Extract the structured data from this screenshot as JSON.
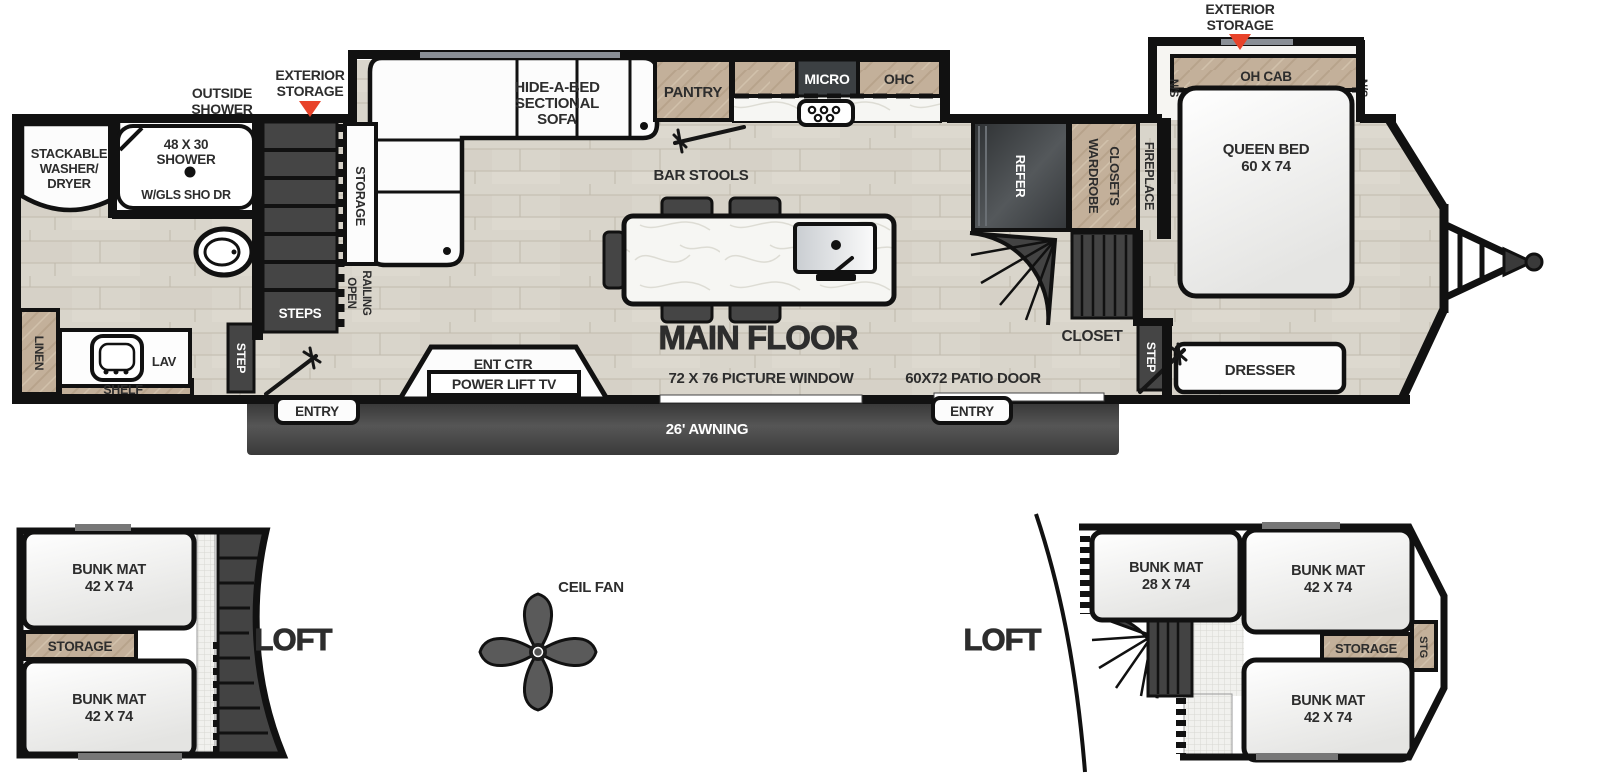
{
  "colors": {
    "floor_wood": "#d9d5cb",
    "cabinet_wood": "#c3b09a",
    "dark_fixture": "#454545",
    "wall": "#111111",
    "accent_red": "#e8432a",
    "awning_gray": "#484848",
    "counter_white": "#f6f6f3"
  },
  "main_floor": {
    "callouts": {
      "outside_shower_l1": "OUTSIDE",
      "outside_shower_l2": "SHOWER",
      "exterior_storage_left_l1": "EXTERIOR",
      "exterior_storage_left_l2": "STORAGE",
      "exterior_storage_right_l1": "EXTERIOR",
      "exterior_storage_right_l2": "STORAGE"
    },
    "bath": {
      "washer_l1": "STACKABLE",
      "washer_l2": "WASHER/",
      "washer_l3": "DRYER",
      "shower_l1": "48 X 30",
      "shower_l2": "SHOWER",
      "shower_l3": "W/GLS SHO DR",
      "linen": "LINEN",
      "lav": "LAV",
      "shelf": "SHELF",
      "step": "STEP"
    },
    "entry_area": {
      "steps": "STEPS",
      "storage": "STORAGE",
      "open": "OPEN",
      "railing": "RAILING",
      "entry": "ENTRY"
    },
    "living": {
      "sofa_l1": "HIDE-A-BED",
      "sofa_l2": "SECTIONAL",
      "sofa_l3": "SOFA",
      "bar_stools": "BAR STOOLS",
      "title": "MAIN FLOOR",
      "ent_ctr": "ENT CTR",
      "power_lift_tv": "POWER LIFT TV",
      "picture_window": "72 X 76 PICTURE WINDOW",
      "awning": "26' AWNING"
    },
    "kitchen": {
      "pantry": "PANTRY",
      "micro": "MICRO",
      "ohc": "OHC",
      "refer": "REFER"
    },
    "hall": {
      "wardrobe_l1": "WARDROBE",
      "wardrobe_l2": "CLOSETS",
      "fireplace": "FIREPLACE",
      "closet": "CLOSET",
      "step": "STEP",
      "patio_door": "60X72 PATIO DOOR",
      "entry": "ENTRY"
    },
    "bedroom": {
      "queen_l1": "QUEEN BED",
      "queen_l2": "60 X 74",
      "oh_cab": "OH CAB",
      "ns_left": "N/S",
      "ns_right": "N/S",
      "dresser": "DRESSER"
    }
  },
  "loft_left": {
    "title": "LOFT",
    "bunk1_l1": "BUNK MAT",
    "bunk1_l2": "42 X 74",
    "storage": "STORAGE",
    "bunk2_l1": "BUNK MAT",
    "bunk2_l2": "42 X 74"
  },
  "ceiling_fan": {
    "label": "CEIL FAN"
  },
  "loft_right": {
    "title": "LOFT",
    "bunk1_l1": "BUNK MAT",
    "bunk1_l2": "28 X 74",
    "bunk2_l1": "BUNK MAT",
    "bunk2_l2": "42 X 74",
    "bunk3_l1": "BUNK MAT",
    "bunk3_l2": "42 X 74",
    "storage": "STORAGE",
    "stg": "STG"
  }
}
